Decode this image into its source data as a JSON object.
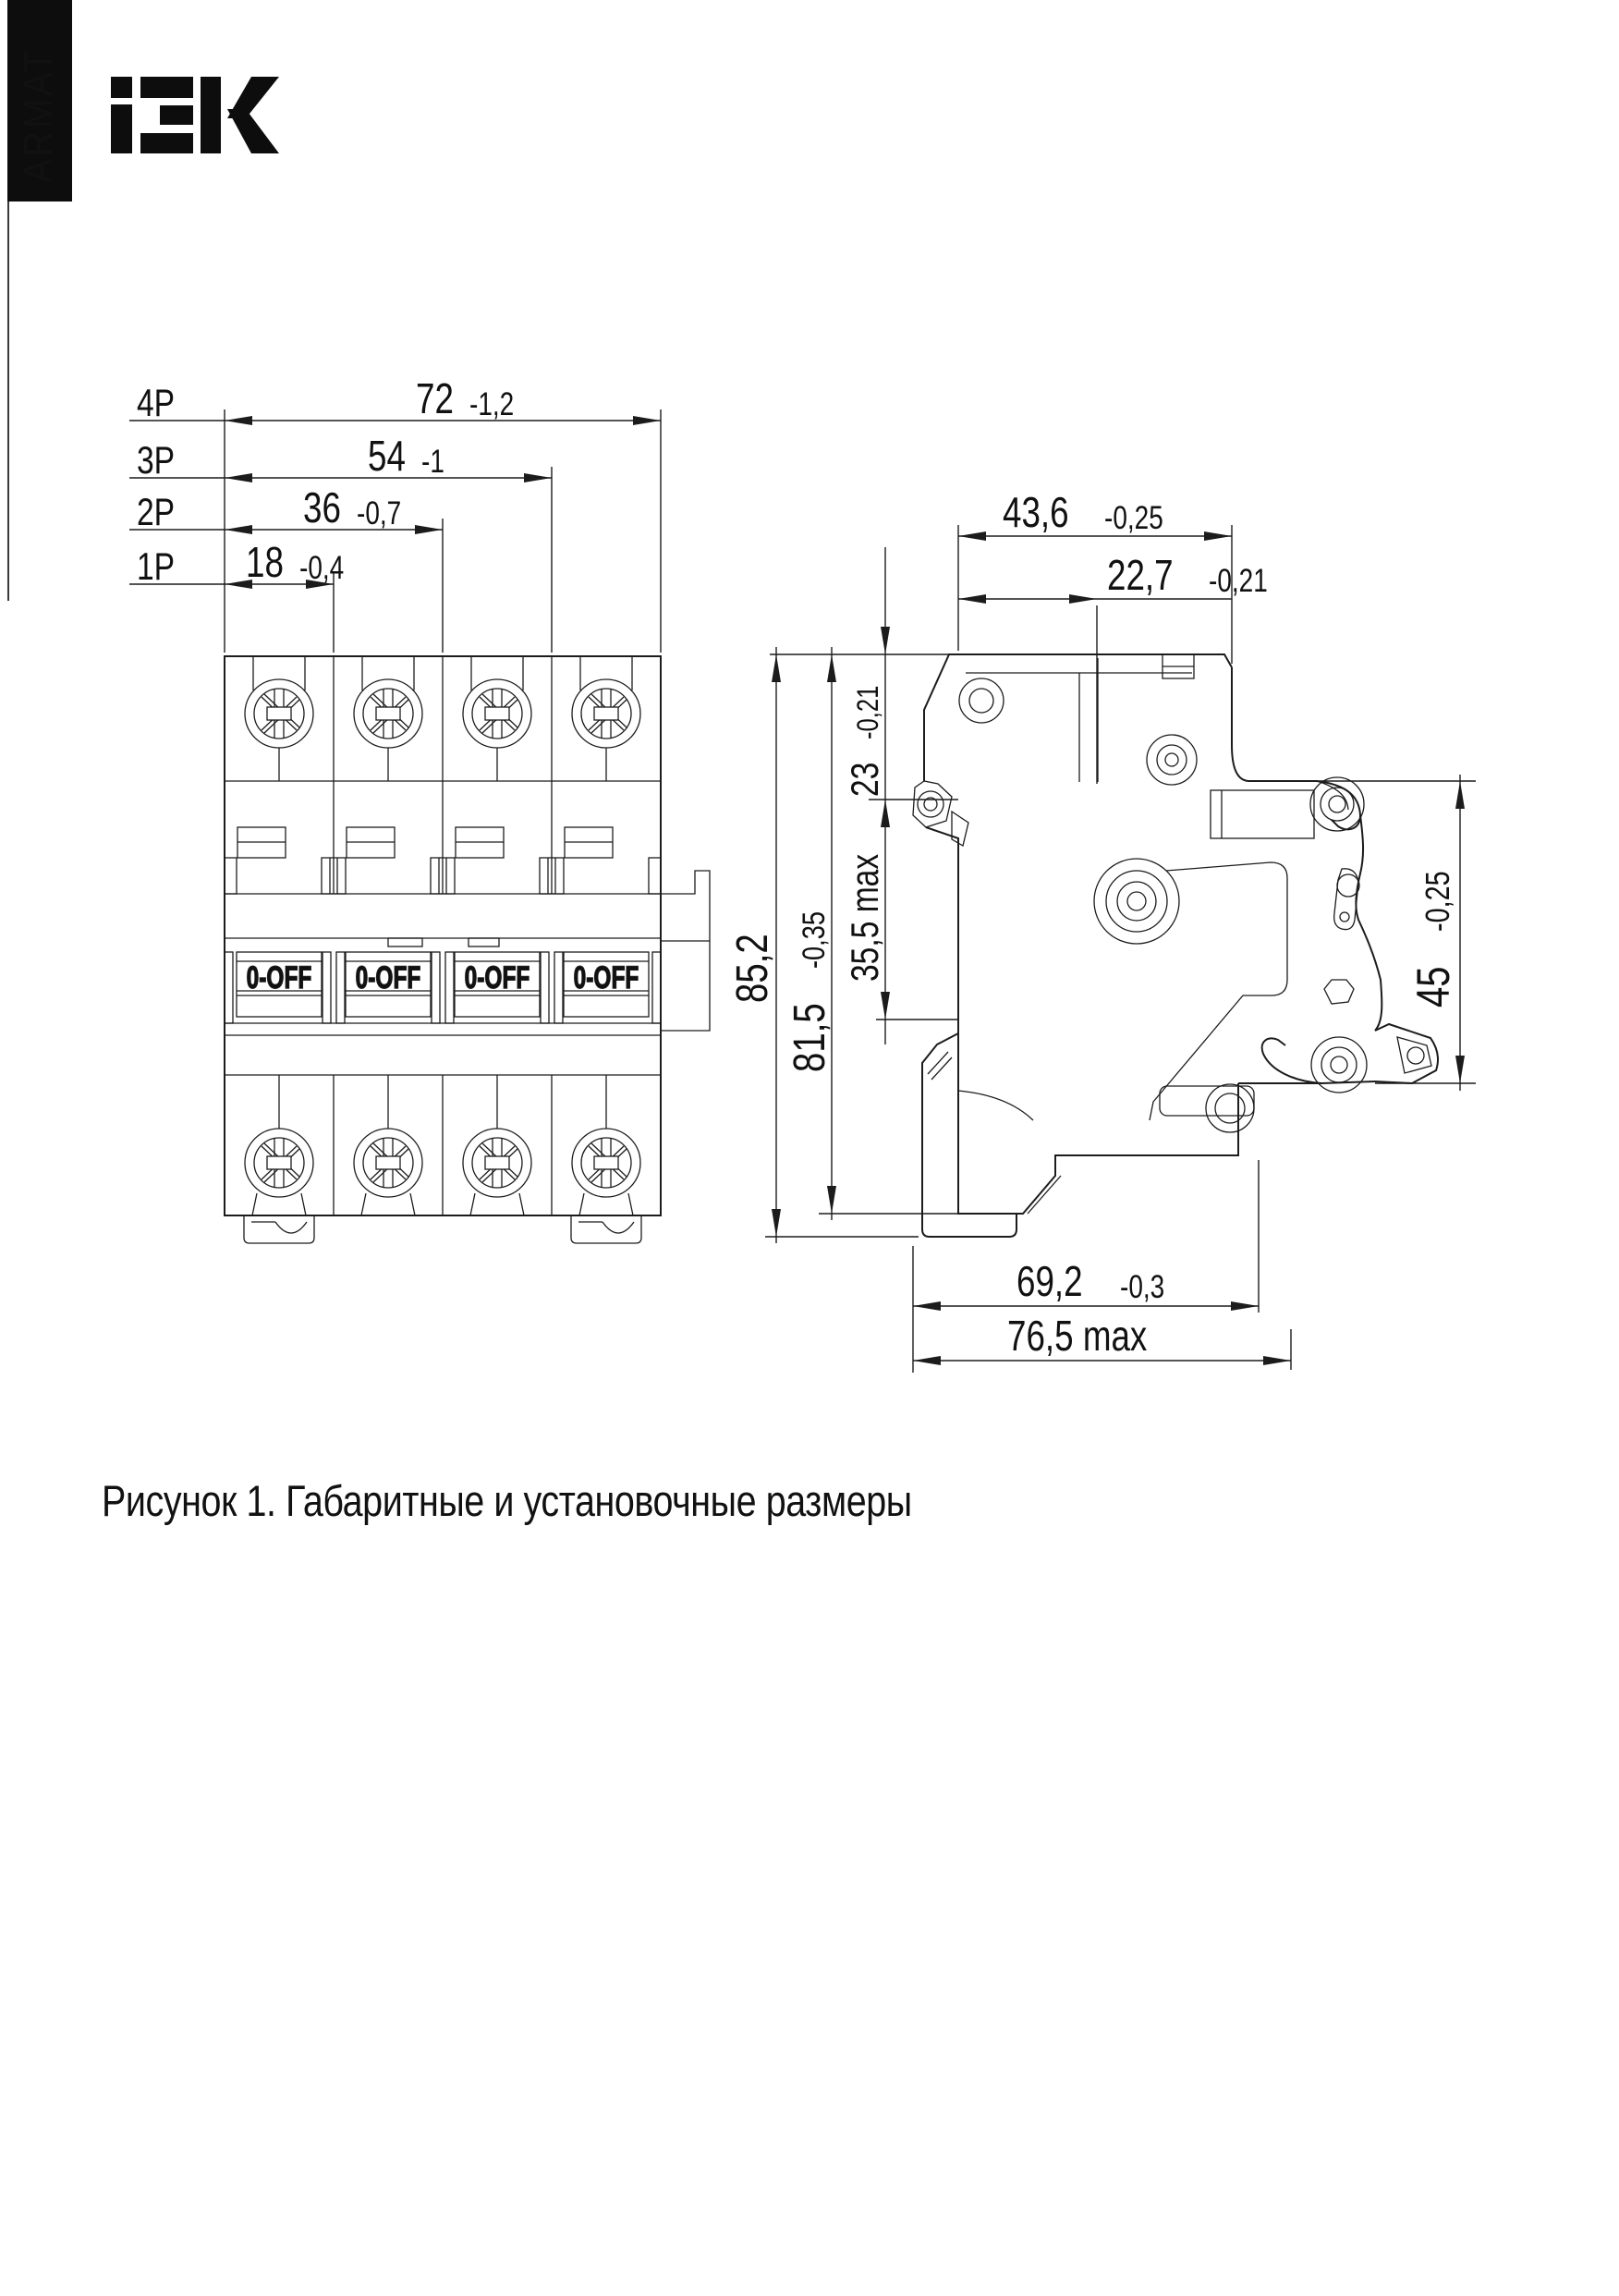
{
  "page": {
    "caption": "Рисунок 1. Габаритные и установочные размеры"
  },
  "brand": {
    "vertical_label": "ARMAT",
    "logo_name": "IEK"
  },
  "front_view": {
    "handle_label": "0-OFF",
    "pole_dims": [
      {
        "pole": "4P",
        "value": "72",
        "tol": "-1,2"
      },
      {
        "pole": "3P",
        "value": "54",
        "tol": "-1"
      },
      {
        "pole": "2P",
        "value": "36",
        "tol": "-0,7"
      },
      {
        "pole": "1P",
        "value": "18",
        "tol": "-0,4"
      }
    ]
  },
  "side_view": {
    "width_total": {
      "value": "43,6",
      "tol": "-0,25"
    },
    "width_step": {
      "value": "22,7",
      "tol": "-0,21"
    },
    "height_total": {
      "value": "85,2"
    },
    "height_body": {
      "value": "81,5",
      "tol": "-0,35"
    },
    "height_top": {
      "value": "23",
      "tol": "-0,21"
    },
    "height_mid": {
      "value": "35,5 max"
    },
    "height_front": {
      "value": "45",
      "tol": "-0,25"
    },
    "depth_body": {
      "value": "69,2",
      "tol": "-0,3"
    },
    "depth_max": {
      "value": "76,5 max"
    }
  }
}
